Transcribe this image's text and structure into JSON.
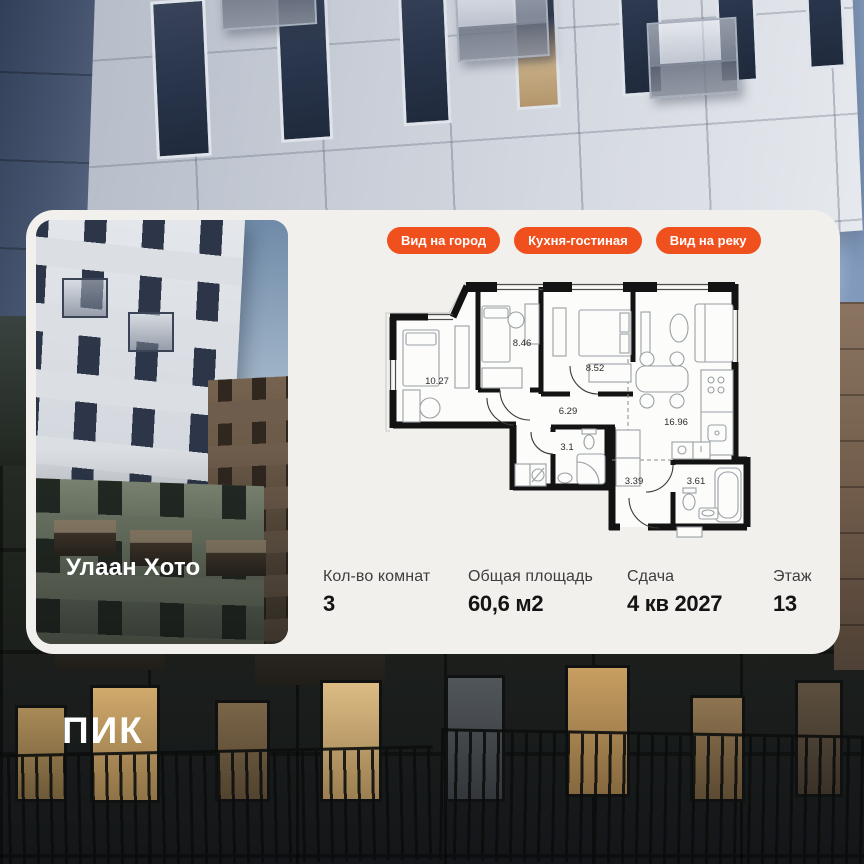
{
  "card": {
    "project_name": "Улаан Хото",
    "badges": [
      {
        "label": "Вид на город"
      },
      {
        "label": "Кухня-гостиная"
      },
      {
        "label": "Вид на реку"
      }
    ],
    "floor_plan": {
      "rooms": [
        {
          "id": "bedroom-1",
          "area": "10.27"
        },
        {
          "id": "bedroom-2",
          "area": "8.46"
        },
        {
          "id": "bedroom-3",
          "area": "8.52"
        },
        {
          "id": "hallway",
          "area": "6.29"
        },
        {
          "id": "kitchen-living",
          "area": "16.96"
        },
        {
          "id": "bathroom-1",
          "area": "3.1"
        },
        {
          "id": "entry-hall",
          "area": "3.39"
        },
        {
          "id": "bathroom-2",
          "area": "3.61"
        }
      ]
    },
    "stats": [
      {
        "label": "Кол-во комнат",
        "value": "3"
      },
      {
        "label": "Общая площадь",
        "value": "60,6 м2"
      },
      {
        "label": "Сдача",
        "value": "4 кв 2027"
      },
      {
        "label": "Этаж",
        "value": "13"
      }
    ]
  },
  "footer": {
    "developer_logo": "ПИК"
  },
  "colors": {
    "accent_orange": "#F0501E",
    "card_background": "#F2F0ED"
  }
}
